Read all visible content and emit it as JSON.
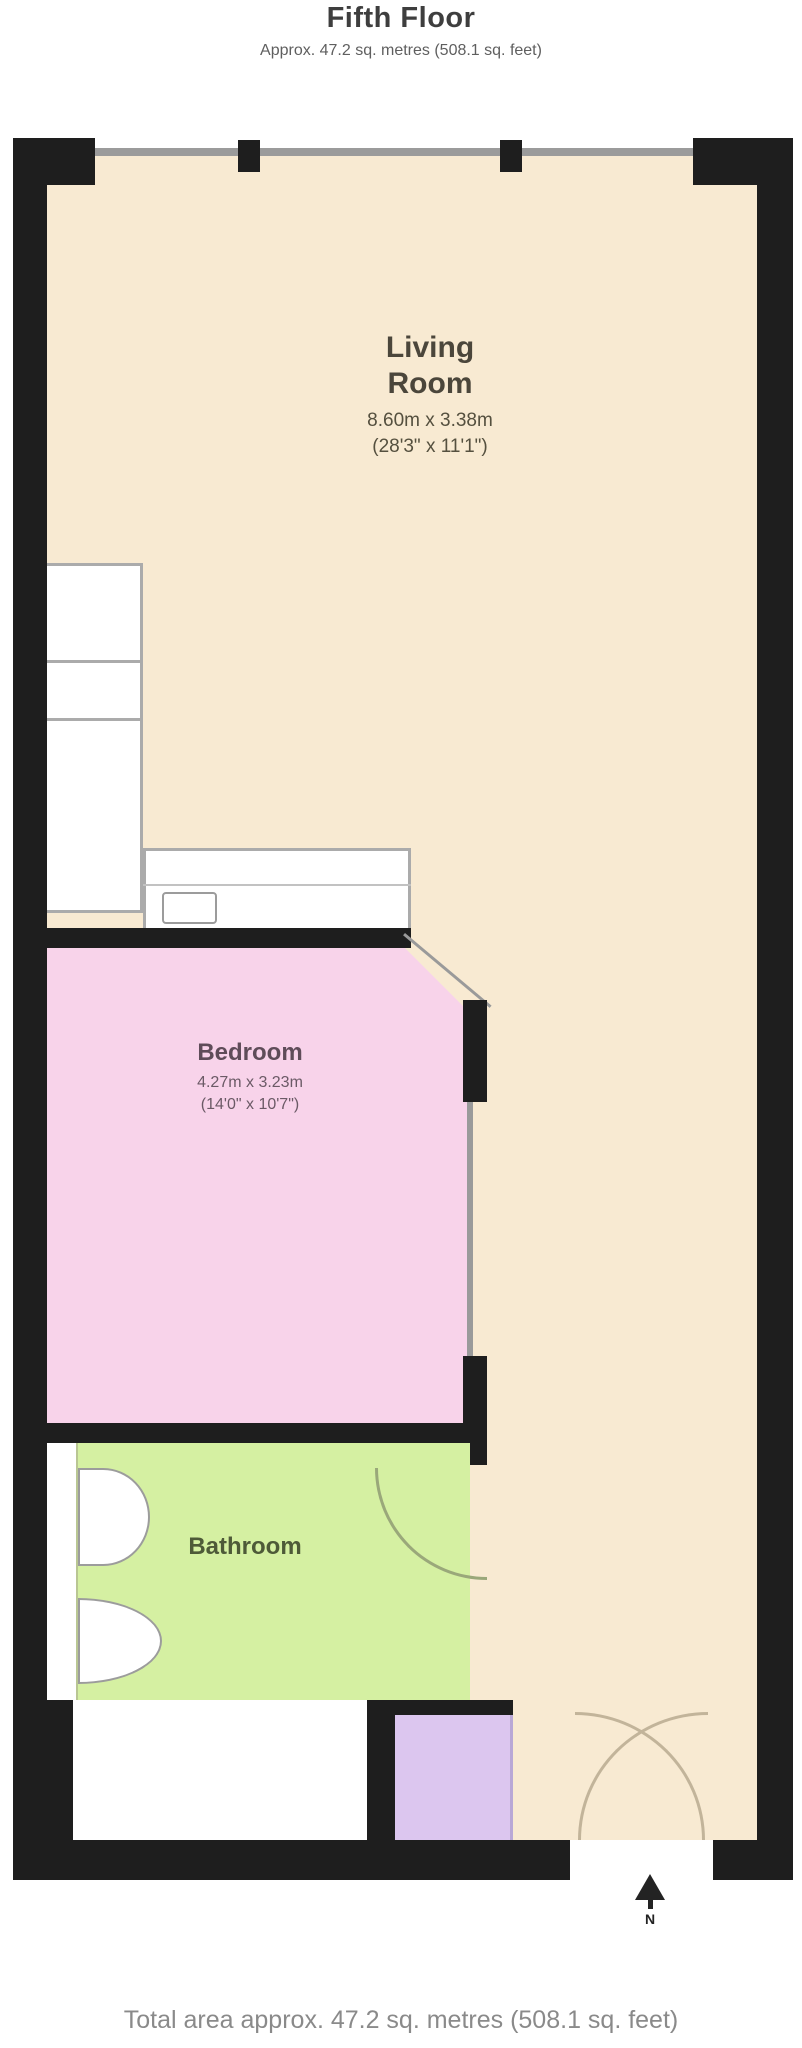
{
  "header": {
    "title": "Fifth Floor",
    "subtitle": "Approx. 47.2 sq. metres (508.1 sq. feet)"
  },
  "rooms": {
    "living_room": {
      "name_line1": "Living",
      "name_line2": "Room",
      "dims_metric": "8.60m x 3.38m",
      "dims_imperial": "(28'3\" x 11'1\")"
    },
    "bedroom": {
      "name": "Bedroom",
      "dims_metric": "4.27m x 3.23m",
      "dims_imperial": "(14'0\" x 10'7\")"
    },
    "bathroom": {
      "name": "Bathroom"
    },
    "closet": {
      "name": ""
    }
  },
  "compass": {
    "label": "N"
  },
  "footer": {
    "total_area": "Total area approx. 47.2 sq. metres (508.1 sq. feet)"
  },
  "colors": {
    "living_room_fill": "#f8ead2",
    "bedroom_fill": "#f8d3ea",
    "bathroom_fill": "#d5f0a2",
    "closet_fill": "#dcc6ef",
    "wall": "#1e1e1e",
    "footer_text": "#8a8a8a"
  }
}
